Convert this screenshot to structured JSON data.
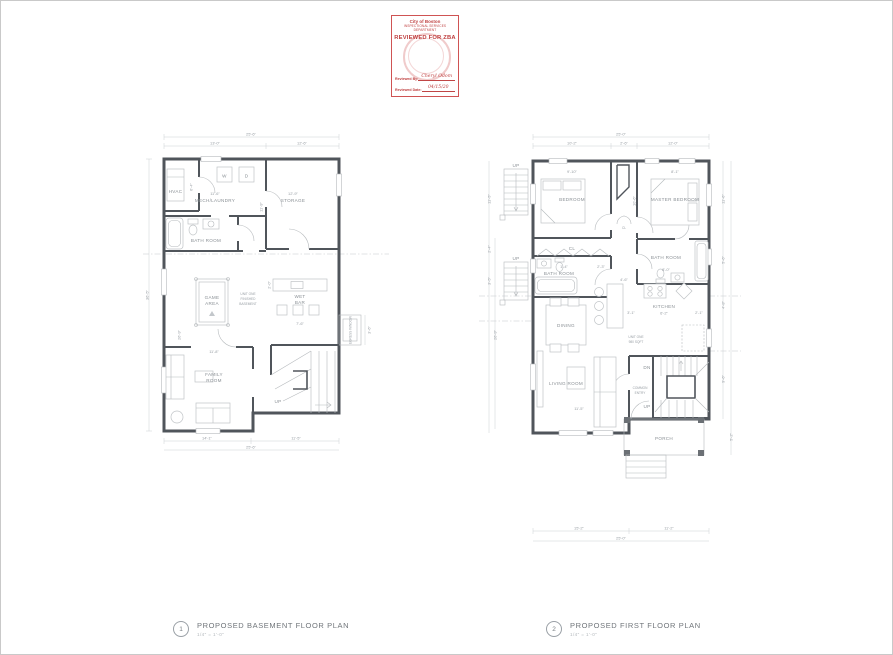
{
  "stamp": {
    "org_line1": "City of Boston",
    "org_line2": "INSPECTIONAL SERVICES DEPARTMENT",
    "title": "REVIEWED FOR ZBA",
    "reviewed_by_label": "Reviewed By:",
    "reviewed_by_value": "Cheryl Odom",
    "date_label": "Reviewed Date:",
    "date_value": "04/15/20"
  },
  "titles": {
    "basement_num": "1",
    "basement_label": "PROPOSED BASEMENT FLOOR PLAN",
    "basement_scale": "1/4\" = 1'-0\"",
    "first_num": "2",
    "first_label": "PROPOSED FIRST FLOOR PLAN",
    "first_scale": "1/4\" = 1'-0\""
  },
  "bsmt": {
    "hvac": "HVAC",
    "mech": "MECH/LAUNDRY",
    "storage": "STORAGE",
    "bath": "BATH ROOM",
    "game1": "GAME",
    "game2": "AREA",
    "wet1": "WET",
    "wet2": "BAR",
    "family1": "FAMILY",
    "family2": "ROOM",
    "w": "W",
    "d": "D",
    "up": "UP",
    "egress": "EGRESS WINDOW",
    "note1": "UNIT ONE",
    "note2": "FINISHED",
    "note3": "BASEMENT",
    "d_top_total": "25'-6\"",
    "d_top1": "13'-0\"",
    "d_top2": "12'-6\"",
    "d_mech": "11'-6\"",
    "d_storage": "12'-9\"",
    "d_storage_h": "11'-9\"",
    "d_hvac": "6'-4\"",
    "d_family": "11'-8\"",
    "d_wet_w": "7'-6\"",
    "d_wet_d": "2'-0\"",
    "d_left_total": "36'-5\"",
    "d_left_inner": "26'-9\"",
    "d_bot1": "14'-1\"",
    "d_bot2": "11'-5\"",
    "d_bot_total": "25'-6\"",
    "d_egress": "3'-6\""
  },
  "ff": {
    "bedroom": "BEDROOM",
    "master": "MASTER BEDROOM",
    "bath_l": "BATH ROOM",
    "bath_r": "BATH ROOM",
    "cl": "CL",
    "dining": "DINING",
    "living": "LIVING ROOM",
    "kitchen": "KITCHEN",
    "common1": "COMMON",
    "common2": "ENTRY",
    "porch": "PORCH",
    "up1": "UP",
    "up2": "UP",
    "up3": "UP",
    "dn": "DN",
    "note1": "UNIT ONE",
    "note2": "980 SQFT",
    "d_top_total": "25'-0\"",
    "d_top1": "10'-2\"",
    "d_top2": "2'-6\"",
    "d_top3": "12'-0\"",
    "d_bedroom": "9'-10\"",
    "d_master": "8'-1\"",
    "d_hall": "10'-6\"",
    "d_bath_r": "8'-0\"",
    "d_bath_l": "1'-4\"",
    "d_23": "2'-3\"",
    "d_cl": "4'-6\"",
    "d_kitchen": "6'-2\"",
    "d_k_l": "3'-1\"",
    "d_k_r": "2'-1\"",
    "d_living": "11'-5\"",
    "d_bot1": "15'-2\"",
    "d_bot2": "11'-2\"",
    "d_bot_total": "25'-0\"",
    "d_r1": "11'-6\"",
    "d_r2": "5'-6\"",
    "d_r3": "4'-8\"",
    "d_r4": "9'-6\"",
    "d_r5": "5'-2\"",
    "d_l1": "11'-5\"",
    "d_l2": "2'-4\"",
    "d_l3": "3'-5\"",
    "d_l4": "26'-9\""
  }
}
